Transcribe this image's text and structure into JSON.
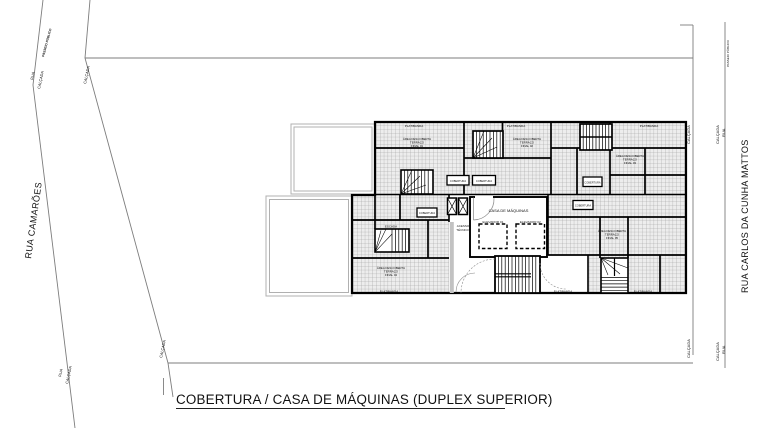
{
  "title": "COBERTURA / CASA DE MÁQUINAS (DUPLEX SUPERIOR)",
  "streets": {
    "left": "RUA CAMARÕES",
    "right": "RUA CARLOS DA CUNHA MATTOS"
  },
  "site_labels": {
    "road": "RUA",
    "sidewalk": "CALÇADA",
    "public_promenade": "PASSEIO PÚBLICO"
  },
  "plan": {
    "machine_room": "CASA DE MÁQUINAS",
    "elevator_1": "ELEVADOR 01",
    "elevator_2": "ELEVADOR 02",
    "stair": "ESCADA",
    "parapet": "PLATIBANDA",
    "tech_access_line1": "ACESSO",
    "tech_access_line2": "TÉCNICO",
    "small_box": "COBERTURA",
    "units": [
      {
        "l1": "ÁREA DESCOBERTA",
        "l2": "TERRAÇO",
        "l3": "FINAL 01"
      },
      {
        "l1": "ÁREA DESCOBERTA",
        "l2": "TERRAÇO",
        "l3": "FINAL 02"
      },
      {
        "l1": "ÁREA DESCOBERTA",
        "l2": "TERRAÇO",
        "l3": "FINAL 03"
      },
      {
        "l1": "ÁREA DESCOBERTA",
        "l2": "TERRAÇO",
        "l3": "FINAL 04"
      },
      {
        "l1": "ÁREA DESCOBERTA",
        "l2": "TERRAÇO",
        "l3": "FINAL 05"
      }
    ]
  },
  "colors": {
    "walls": "#000000",
    "site_lines": "#7d7d7d",
    "hatch_line": "#9c9c9c",
    "hatch_bg": "#ededed",
    "text": "#111111"
  }
}
